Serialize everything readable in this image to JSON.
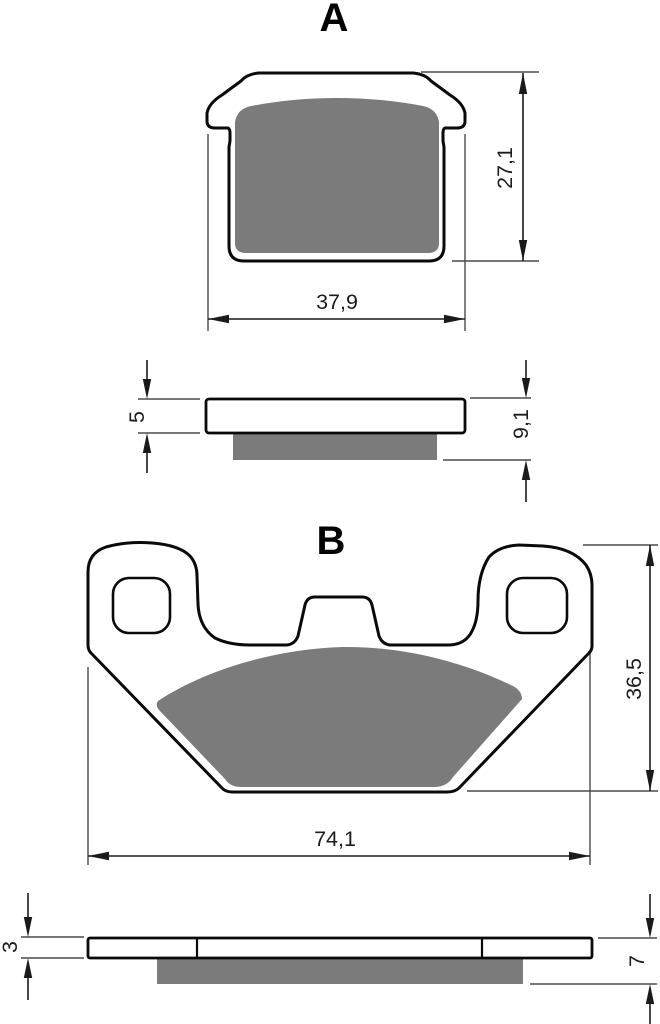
{
  "drawing": {
    "background": "#ffffff",
    "colors": {
      "outline": "#0a0a0a",
      "friction_pad": "#7b7b7b",
      "dimension_line": "#1a1a1a",
      "extension_line": "#4a4a4a",
      "text": "#1c1c1c"
    },
    "sections": {
      "a": {
        "label": "A",
        "front": {
          "width": "37,9",
          "height": "27,1"
        },
        "side": {
          "backing": "5",
          "total": "9,1"
        }
      },
      "b": {
        "label": "B",
        "front": {
          "width": "74,1",
          "height": "36,5"
        },
        "side": {
          "backing": "3",
          "total": "7"
        }
      }
    }
  }
}
